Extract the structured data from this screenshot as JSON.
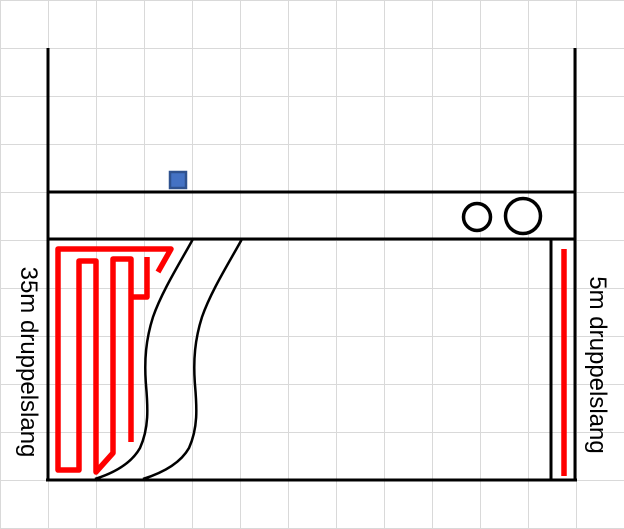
{
  "labels": {
    "left_hose": "35m druppelslang",
    "right_hose": "5m druppelslang"
  },
  "colors": {
    "hose_red": "#FF0000",
    "outline_black": "#000000",
    "square_blue_fill": "#4472C4",
    "square_blue_border": "#2F528F",
    "gridline_gray": "#D9D9D9",
    "background": "#FFFFFF"
  },
  "diagram": {
    "left_wall_d": "M48,48 L48,481",
    "right_wall_d": "M575,48 L575,481",
    "upper_divider_d": "M47,192 L576,192",
    "lower_divider_d": "M47,239 L576,239",
    "bottom_wall_d": "M46,480 L577,480",
    "inner_right_wall_d": "M551,240 L551,480",
    "left_path_curve_d": "M193,239 C181,261 162,291 153,317 C146,339 144,360 146,385 C148,408 149,428 140,448 C131,464 114,473 95,479",
    "right_path_curve_d": "M242,239 C230,261 211,291 202,317 C195,339 193,360 195,385 C197,408 198,428 189,448 C180,464 162,473 143,479",
    "hose_35m_points": "158,272 171,249 58,249 58,470 79,470 79,261 96,261 96,472 113,453 113,259 131,259 131,442",
    "hose_35m_stub_points": "131,297 147,297 147,257",
    "hose_5m_d": "M564,249 L564,476",
    "blue_square_d": "M170,172 h16 v16 h-16 Z",
    "small_circle": {
      "cx": 477,
      "cy": 217,
      "r": 13.5
    },
    "large_circle": {
      "cx": 523,
      "cy": 216,
      "r": 17.5
    }
  }
}
